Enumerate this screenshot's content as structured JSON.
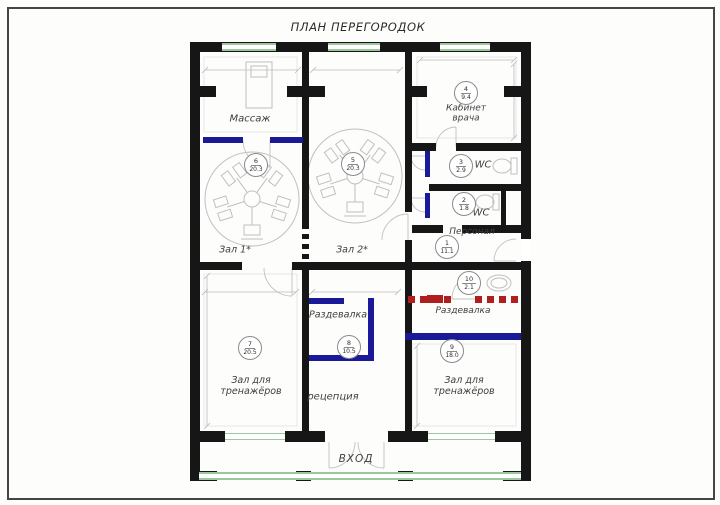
{
  "title": "ПЛАН ПЕРЕГОРОДОК",
  "rooms": {
    "massage": {
      "label": "Массаж"
    },
    "hall1": {
      "label": "Зал 1*",
      "num": "6",
      "area": "20.3"
    },
    "hall2": {
      "label": "Зал 2*",
      "num": "5",
      "area": "20.3"
    },
    "doctor": {
      "label_line1": "Кабинет",
      "label_line2": "врача",
      "num": "4",
      "area": "9.4"
    },
    "wc_top": {
      "label": "WC",
      "num": "3",
      "area": "2.9"
    },
    "wc_bottom": {
      "label": "WC",
      "num": "2",
      "area": "1.8"
    },
    "staff": {
      "label": "Персонал",
      "num": "1",
      "area": "11.1"
    },
    "shower": {
      "num": "10",
      "area": "2.1"
    },
    "dressing_right": {
      "label": "Раздевалка"
    },
    "dressing_center": {
      "label": "Раздевалка",
      "num": "8",
      "area": "10.5"
    },
    "gym_left": {
      "label_line1": "Зал для",
      "label_line2": "тренажёров",
      "num": "7",
      "area": "20.5"
    },
    "gym_right": {
      "label_line1": "Зал для",
      "label_line2": "тренажёров",
      "num": "9",
      "area": "18.0"
    },
    "reception": {
      "label": "рецепция"
    },
    "entrance": {
      "label": "ВХОД"
    }
  },
  "colors": {
    "wall": "#161616",
    "new_partition_blue": "#1a1a99",
    "partition_red": "#b01f1f",
    "glazing_green": "#9cc69c"
  }
}
